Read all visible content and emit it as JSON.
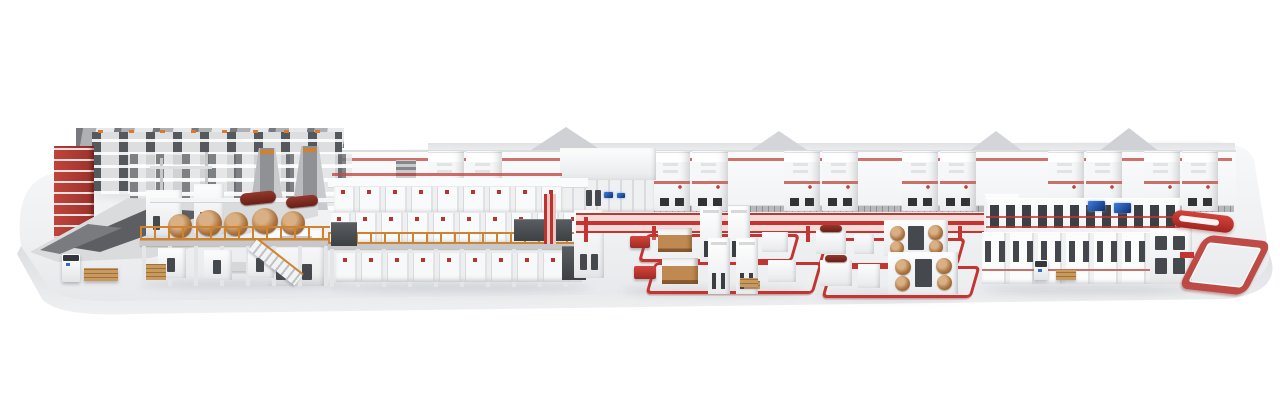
{
  "image": {
    "kind": "3d-render",
    "subject": "Complete automated corrugated-board production line displayed on a white showcase platform",
    "background_color": "#ffffff",
    "visible_text": ""
  },
  "palette": {
    "accent_red": "#c23531",
    "rail_orange": "#d0832f",
    "roll_brown": "#a9713d",
    "dark_roll_red": "#7e2a22",
    "machine_white": "#f6f7f8",
    "steel_gray": "#55585c",
    "screen_blue": "#2e6bd8",
    "platform_top": "#eef0f2",
    "platform_front": "#e2e4e7"
  },
  "platform": {
    "label": "White rounded showcase platform"
  },
  "sections": {
    "sawtooth_roof": {
      "label": "Saw-tooth factory roofs (back left)"
    },
    "roll_storage": {
      "label": "Paper roll storage rack system"
    },
    "red_rack": {
      "label": "Red vertical storage rack"
    },
    "splicer_towers": {
      "label": "Splicer A-frame towers"
    },
    "splice_deck": {
      "label": "Gray roll-handling deck"
    },
    "reel_stand": {
      "label": "Reel stand / roll loading machine"
    },
    "wet_end": {
      "label": "Wet end mezzanine with paper rolls"
    },
    "stairs": {
      "label": "Mezzanine access stairs"
    },
    "corrugator": {
      "label": "Corrugator line modules on elevated platform"
    },
    "steam_tower": {
      "label": "Steam piping tower"
    },
    "factory_wall": {
      "label": "Back wall with gabled roofs"
    },
    "wall_cabinets": {
      "label": "Utility cabinet units along back wall"
    },
    "control_block": {
      "label": "Control cabinets with displays"
    },
    "dry_end_lines": {
      "label": "Red floor conveyor lines (dry end)"
    },
    "island1": {
      "label": "Converting island with stackers and red conveyor loops"
    },
    "island2": {
      "label": "Converting island with printing roll units"
    },
    "finishing_line": {
      "label": "Finishing and logistics line with control screens"
    },
    "red_pill": {
      "label": "Red shuttle conveyor"
    },
    "red_loop": {
      "label": "Red sorting conveyor loop"
    },
    "agv": {
      "label": "Automated guided vehicle"
    },
    "pallet_cart": {
      "label": "Pallet transfer cart"
    }
  }
}
